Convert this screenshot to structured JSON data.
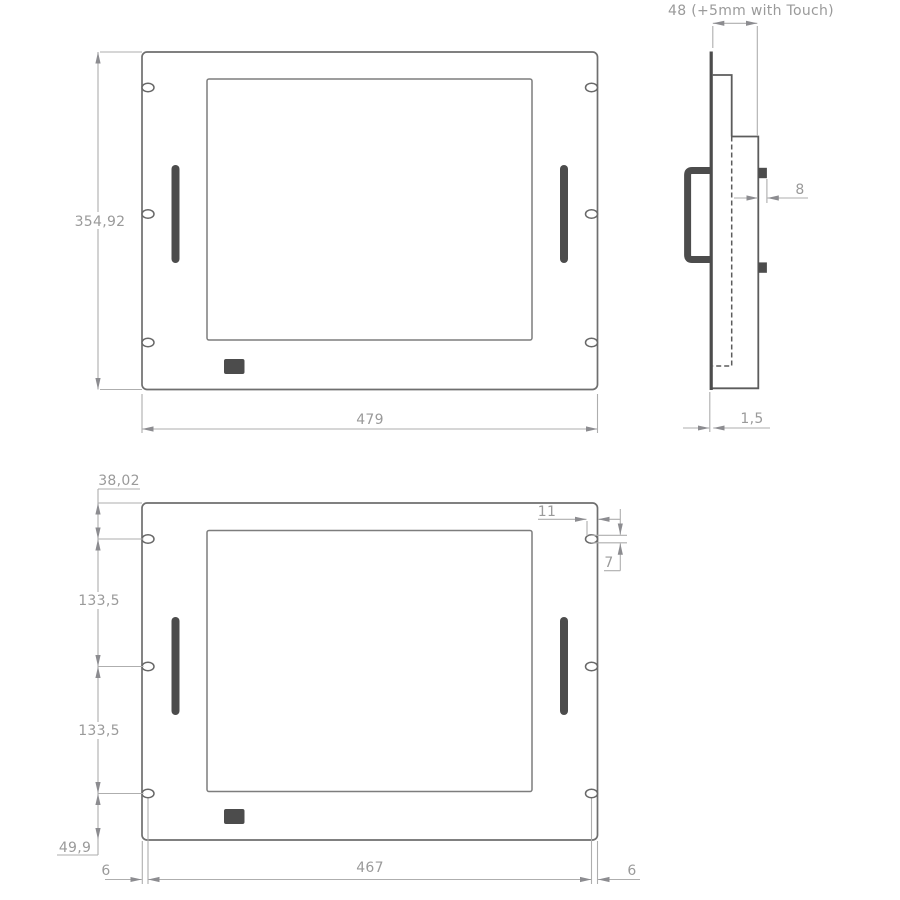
{
  "colors": {
    "background": "#ffffff",
    "outline_gray": "#6f6f6f",
    "detail_gray": "#5c5c5c",
    "dark_fill": "#4c4c4c",
    "dim_line_gray": "#aeaeae",
    "dim_text_gray": "#9a9a9a"
  },
  "front_view_top": {
    "dim_height": "354,92",
    "dim_width": "479"
  },
  "side_view": {
    "dim_depth": "48 (+5mm with Touch)",
    "dim_stud_length": "8",
    "dim_front_panel_thickness": "1,5"
  },
  "front_view_bottom": {
    "dim_top_edge_to_first_hole": "38,02",
    "dim_hole_pitch_upper": "133,5",
    "dim_hole_pitch_lower": "133,5",
    "dim_last_hole_to_bottom_edge": "49,9",
    "dim_left_edge_to_hole_center": "6",
    "dim_hole_center_span": "467",
    "dim_hole_center_to_right_edge": "6",
    "dim_slot_width": "11",
    "dim_slot_height": "7"
  }
}
